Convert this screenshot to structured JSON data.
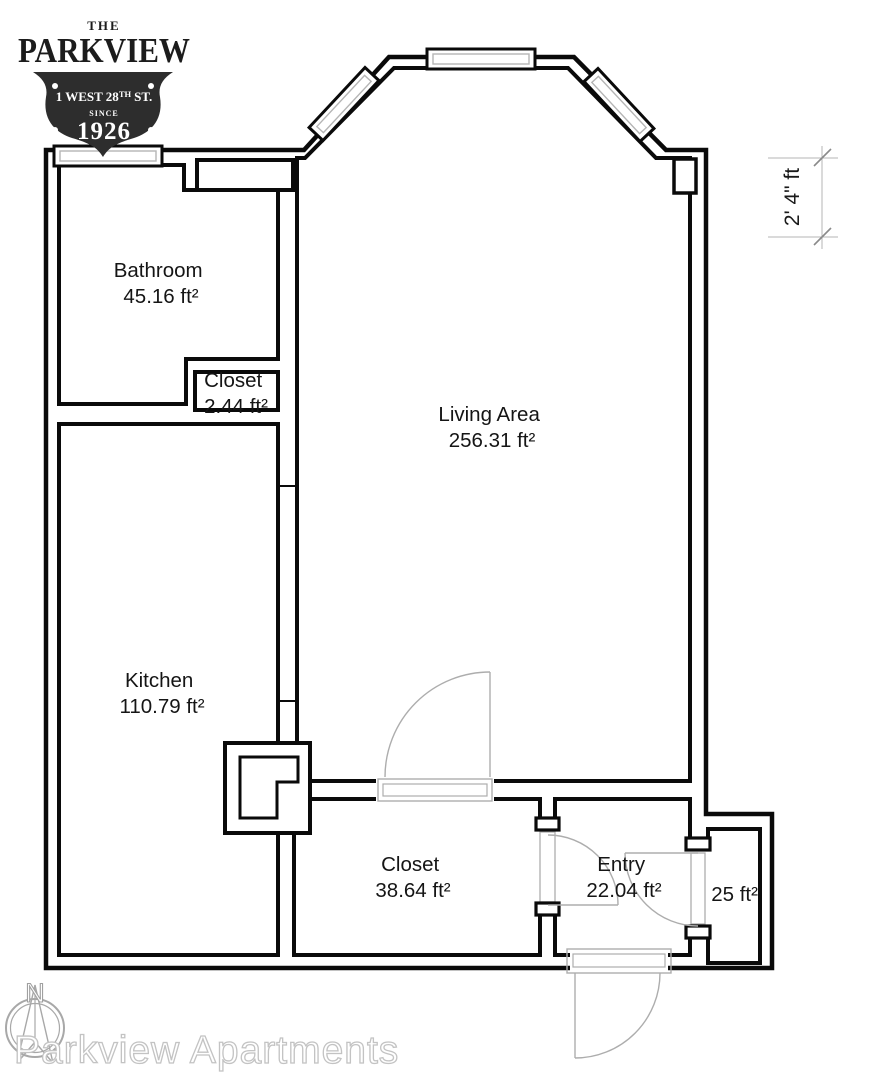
{
  "logo": {
    "the": "THE",
    "name": "PARKVIEW",
    "address_prefix": "1 WEST 28",
    "address_sup": "TH",
    "address_suffix": "ST.",
    "since": "SINCE",
    "year": "1926"
  },
  "rooms": {
    "bathroom": {
      "label": "Bathroom",
      "area": "45.16 ft²"
    },
    "closet_small": {
      "label": "Closet",
      "area": "2.44 ft²"
    },
    "living_area": {
      "label": "Living Area",
      "area": "256.31 ft²"
    },
    "kitchen": {
      "label": "Kitchen",
      "area": "110.79 ft²"
    },
    "closet_large": {
      "label": "Closet",
      "area": "38.64 ft²"
    },
    "entry": {
      "label": "Entry",
      "area": "22.04 ft²"
    },
    "side_room": {
      "area": "6.25 ft²"
    }
  },
  "dimension": {
    "label": "2' 4\" ft"
  },
  "compass": {
    "north": "N"
  },
  "watermark": {
    "text": "Parkview Apartments"
  },
  "colors": {
    "wall": "#0a0a0a",
    "door_gray": "#adadad",
    "dimension_gray": "#b5b5b5",
    "watermark_outline": "#c3c3c3",
    "logo_dark": "#2d2d2d"
  }
}
